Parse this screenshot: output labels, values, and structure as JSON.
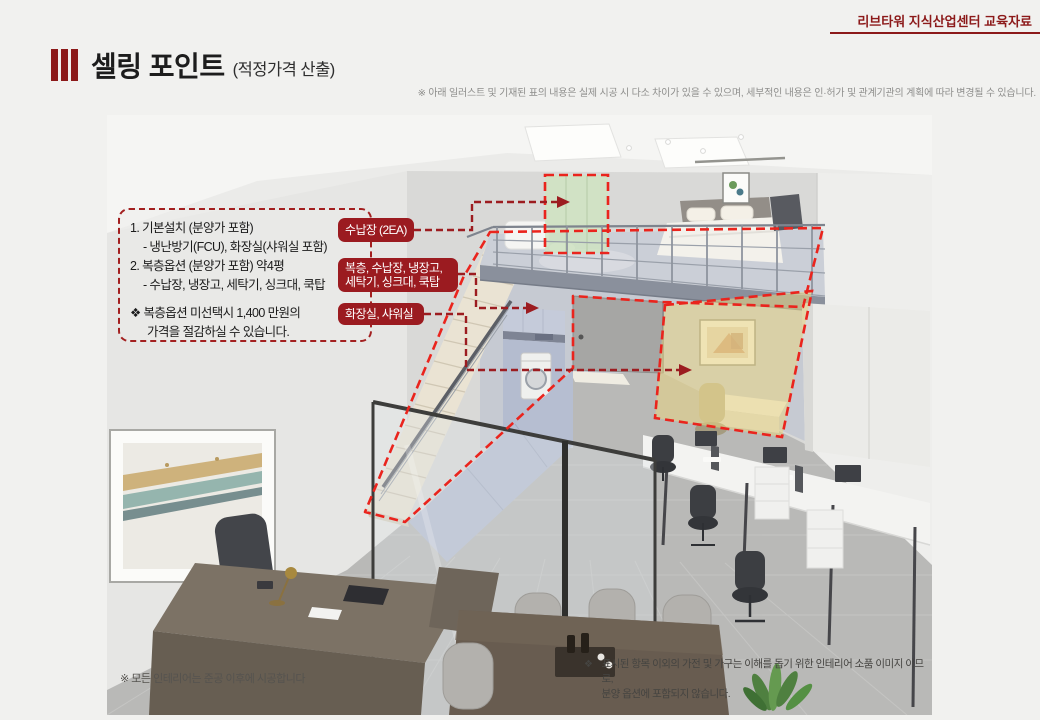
{
  "header": {
    "top_right": "리브타워 지식산업센터 교육자료"
  },
  "title": {
    "main": "셀링 포인트",
    "sub": "(적정가격 산출)"
  },
  "disclaimer": "※ 아래 일러스트 및 기재된 표의 내용은 실제 시공 시 다소 차이가 있을 수 있으며, 세부적인 내용은 인·허가 및 관계기관의 계획에 따라 변경될 수 있습니다.",
  "info_box": {
    "lines": [
      "1. 기본설치 (분양가 포함)",
      "- 냉난방기(FCU), 화장실(샤워실 포함)",
      "2. 복층옵션 (분양가 포함) 약4평",
      "- 수납장, 냉장고, 세탁기, 싱크대, 쿡탑",
      "❖  복층옵션 미선택시 1,400 만원의",
      "가격을 절감하실 수 있습니다."
    ]
  },
  "labels": {
    "storage": "수납장 (2EA)",
    "duplex1": "복층, 수납장, 냉장고,",
    "duplex2": "세탁기, 싱크대, 쿡탑",
    "bathroom": "화장실, 샤워실"
  },
  "notes": {
    "bottom_left": "※ 모든 인테리어는 준공 이후에 시공합니다",
    "props_bullet": "❖",
    "props_line1": "표시된 항목 이외의 가전 및 가구는 이해를 돕기 위한 인테리어 소품 이미지 이므로,",
    "props_line2": "분양 옵션에 포함되지 않습니다."
  },
  "colors": {
    "accent_red": "#8c1a1a",
    "tag_red": "#9b1b20",
    "dash_bright_red": "#ea241d",
    "connector_dark_red": "#9c1c20",
    "highlight_yellow": "#e9d584",
    "highlight_green": "#cfe3c2"
  }
}
